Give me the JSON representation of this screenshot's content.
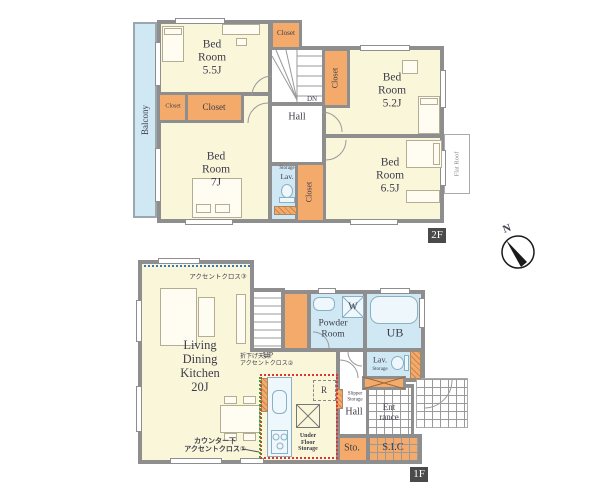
{
  "colors": {
    "wall": "#8e8e8e",
    "room_cream": "#faf6da",
    "closet_orange": "#f3aa6b",
    "wet_blue": "#cfe8f3",
    "accent1_green": "#2fa838",
    "accent2_red": "#e23333",
    "accent3_blue": "#3377cc",
    "badge_dark": "#4a4a4a"
  },
  "compass": {
    "north": "N"
  },
  "floor2": {
    "badge": "2F",
    "balcony": "Balcony",
    "bedroom_5_5": "Bed\nRoom\n5.5J",
    "bedroom_5_2": "Bed\nRoom\n5.2J",
    "bedroom_7": "Bed\nRoom\n7J",
    "bedroom_6_5": "Bed\nRoom\n6.5J",
    "hall": "Hall",
    "stairs_dn": "DN",
    "lavatory": "Lav.",
    "lavatory_storage": "Storage",
    "closet_top": "Closet",
    "closet_5_2": "Closet",
    "closet_7_small": "Closet",
    "closet_7_large": "Closet",
    "closet_6_5": "Closet",
    "flat_roof": "Flat Roof"
  },
  "floor1": {
    "badge": "1F",
    "ldk": "Living\nDining\nKitchen\n20J",
    "accent_cloth_3": "アクセントクロス③",
    "accent_cloth_2": "折下げ天井\nアクセントクロス②",
    "accent_cloth_1": "カウンター下\nアクセントクロス①",
    "stairs_up": "UP",
    "powder_room": "Powder\nRoom",
    "washer": "W",
    "unit_bath": "UB",
    "lavatory": "Lav.",
    "lavatory_storage": "Storage",
    "refrigerator": "R",
    "slipper_storage": "Slipper\nStorage",
    "hall": "Hall",
    "entrance": "Ent\nrance",
    "under_floor_storage": "Under\nFloor\nStorage",
    "storage": "Sto.",
    "shoe_in_closet": "S.I.C"
  }
}
